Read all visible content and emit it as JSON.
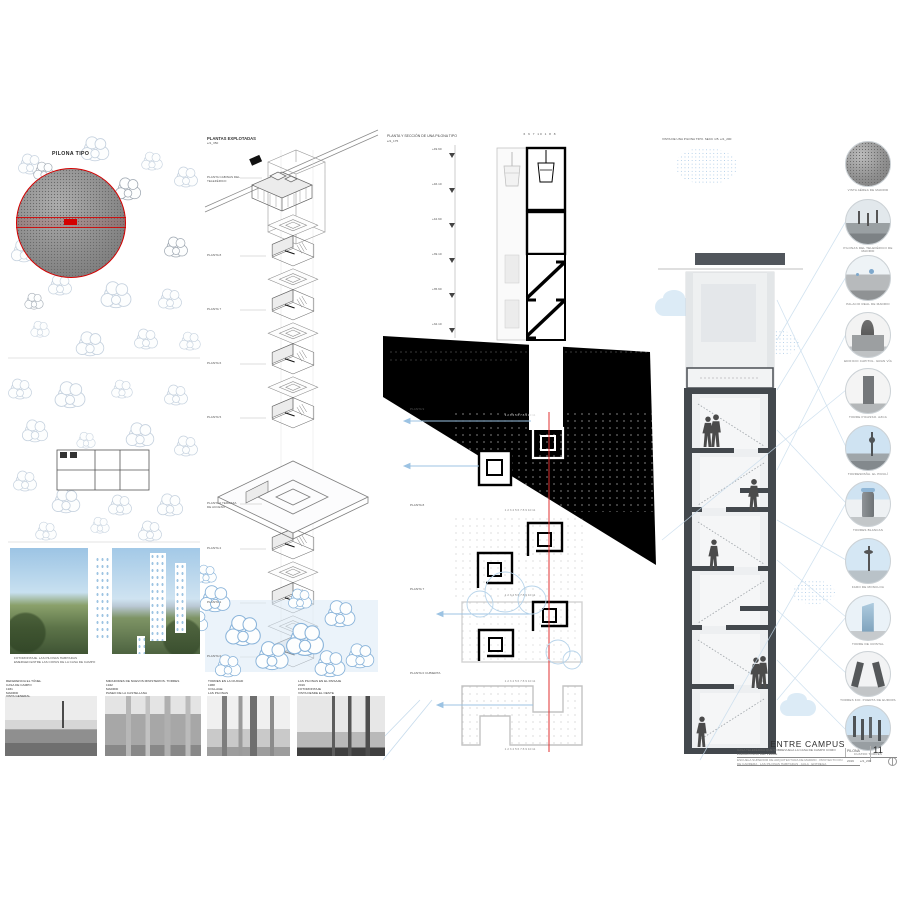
{
  "left_panel": {
    "pilona_label": "PILONA TIPO",
    "montage_caption": "FOTOMONTAJE. LAS PILONAS HABITADAS\nEMERGEN ENTRE LAS COPAS DE LA CASA DE CAMPO",
    "photos": [
      {
        "caption": "REFERENCIA EL TÚNEL\nCASA DE CAMPO\n1931\nMADRID\nVISTA GENERAL"
      },
      {
        "caption": "MIRADORES DE NUEVOS MINISTERIOS. TORRES\n1942\nMADRID\nPASEO DE LA CASTELLANA"
      },
      {
        "caption": "TORRES EN LA CIUDAD\n1968\nCOLLAGE\nLAS PILONAS"
      },
      {
        "caption": "LAS PILONAS EN EL PAISAJE\n2019\nFOTOMONTAJE\nVISTA DESDE EL OESTE"
      }
    ]
  },
  "exploded": {
    "title": "PLANTAS EXPLOTADAS",
    "scale": "e/1_350",
    "levels": [
      {
        "label": "PLANTA CABINAS DEL TELEFÉRICO",
        "y": 176
      },
      {
        "label": "PLANTA 8",
        "y": 254
      },
      {
        "label": "PLANTA 7",
        "y": 308
      },
      {
        "label": "PLANTA 6",
        "y": 362
      },
      {
        "label": "PLANTA 5",
        "y": 416
      },
      {
        "label": "PLANTA 0 TERRAZA DE ACCESO",
        "y": 502
      },
      {
        "label": "PLANTA 2",
        "y": 547
      },
      {
        "label": "PLANTA 1",
        "y": 601
      },
      {
        "label": "PLANTA 0",
        "y": 655
      }
    ]
  },
  "section_center": {
    "title": "PLANTA Y SECCIÓN DE UNA PILONA TIPO",
    "scale": "e/1_175",
    "grid_top": "6   6   7   10   1   8   8",
    "grid_row": "1    2  3    4    5    6    7  8    9  10    11",
    "cotas": [
      {
        "label": "+49.60",
        "y": 148
      },
      {
        "label": "+46.10",
        "y": 183
      },
      {
        "label": "+42.60",
        "y": 218
      },
      {
        "label": "+39.10",
        "y": 253
      },
      {
        "label": "+35.60",
        "y": 288
      },
      {
        "label": "+32.10",
        "y": 323
      }
    ],
    "plan_labels": [
      {
        "label": "PLANTA 9",
        "y": 408
      },
      {
        "label": "PLANTA 8",
        "y": 504
      },
      {
        "label": "PLANTA 7",
        "y": 588
      },
      {
        "label": "PLANTA 0 CUBIERTA",
        "y": 672
      }
    ]
  },
  "section_right": {
    "title": "VISTA DE UNA PILONA TIPO. SECC 1/5. e/1_200"
  },
  "references": {
    "circles": [
      {
        "label": "VISTA AÉREA DE MADRID",
        "kind": "aerial",
        "y": 141
      },
      {
        "label": "PILONAS DEL TELEFÉRICO DE MADRID",
        "kind": "pylons",
        "y": 199
      },
      {
        "label": "PALACIO REAL DE MADRID",
        "kind": "palace",
        "y": 255
      },
      {
        "label": "EDIFICIO CAPITOL. GRAN VÍA",
        "kind": "capitol",
        "y": 312
      },
      {
        "label": "TORRE PICASSO. AZCA",
        "kind": "picasso",
        "y": 368
      },
      {
        "label": "TORRESPAÑA. EL PIRULÍ",
        "kind": "piruli",
        "y": 425
      },
      {
        "label": "TORRES BLANCAS",
        "kind": "blancas",
        "y": 481
      },
      {
        "label": "FARO DE MONCLOA",
        "kind": "faro",
        "y": 538
      },
      {
        "label": "TORRE DE CRISTAL",
        "kind": "cristal",
        "y": 595
      },
      {
        "label": "TORRES KIO. PUERTA DE EUROPA",
        "kind": "kio",
        "y": 651
      },
      {
        "label": "CUATRO TORRES",
        "kind": "cuatro",
        "y": 705
      }
    ]
  },
  "title_block": {
    "project_title": "ENTRE CAMPUS",
    "subtitle": "CASA TELEFÉRICA QUE SOBREVUELA LA CASA DE CAMPO COMO LABORATORIO DEL VERDE",
    "sheet_label": "PILONA",
    "page_number": "11",
    "footer": "ESCUELA SUPERIOR DE ARQUITECTURA DE MADRID · PROYECTO FIN DE CARRERA · LAS PILONAS HABITADAS · AULA · ENTREGA",
    "year": "2019",
    "scale": "e/1_200"
  }
}
